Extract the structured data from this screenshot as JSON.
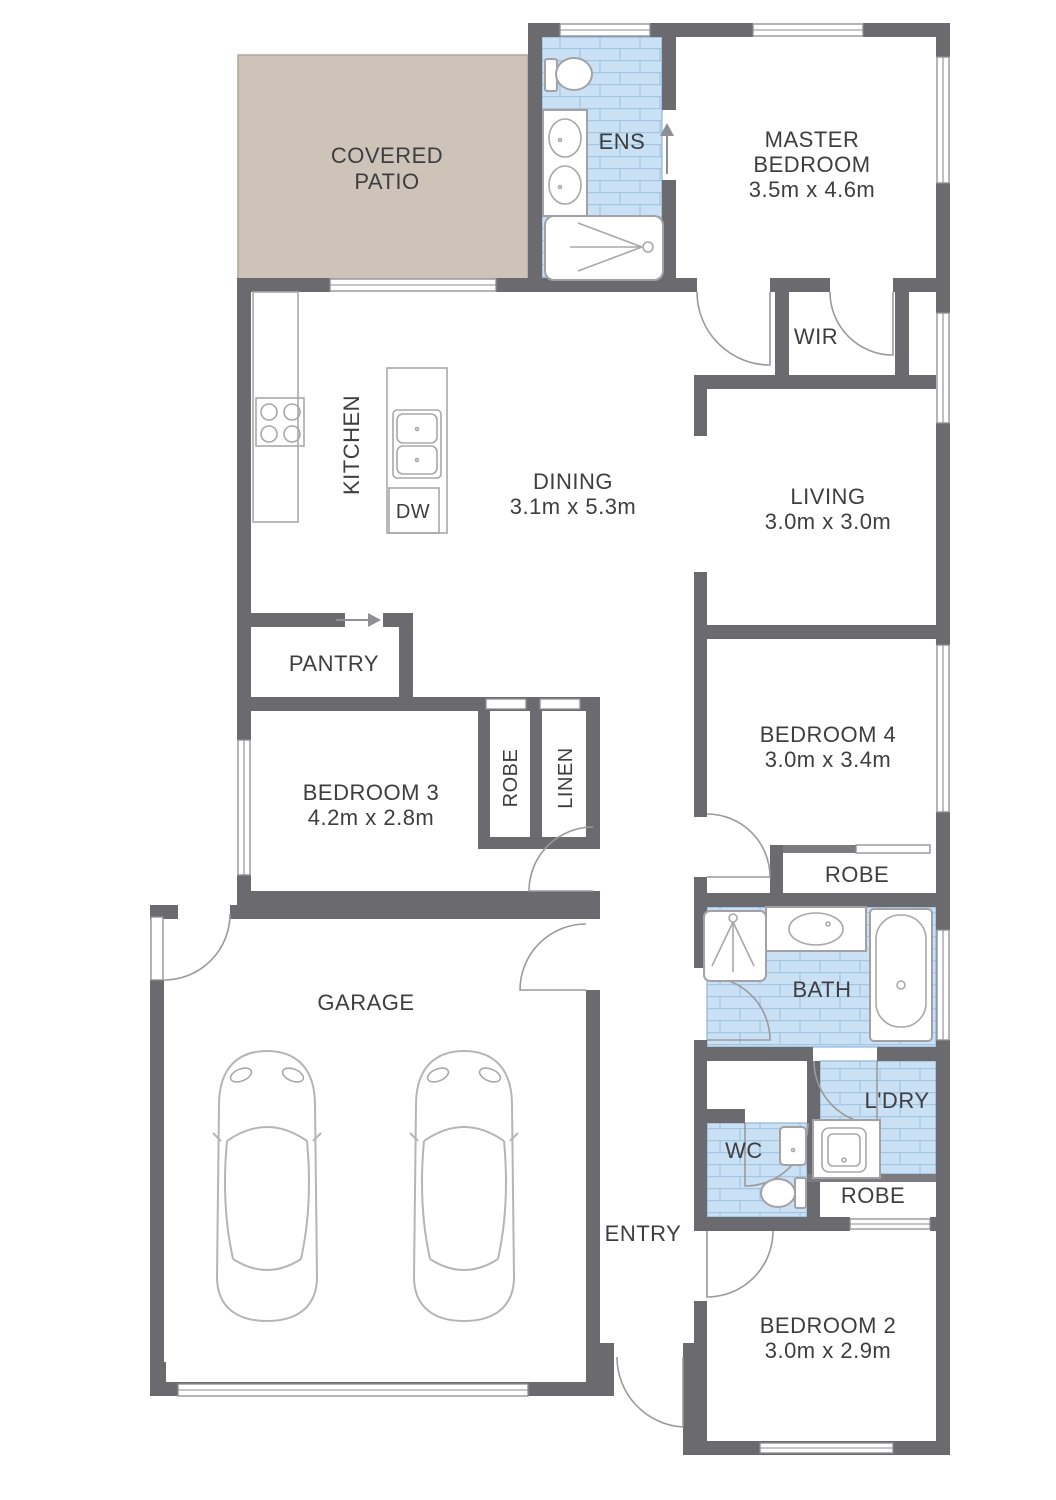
{
  "rooms": {
    "covered_patio": {
      "name_line1": "COVERED",
      "name_line2": "PATIO"
    },
    "ensuite": {
      "name": "ENS"
    },
    "master_bedroom": {
      "name_line1": "MASTER",
      "name_line2": "BEDROOM",
      "dimensions": "3.5m x 4.6m"
    },
    "wir": {
      "name": "WIR"
    },
    "kitchen": {
      "name": "KITCHEN",
      "dishwasher": "DW"
    },
    "dining": {
      "name": "DINING",
      "dimensions": "3.1m x 5.3m"
    },
    "living": {
      "name": "LIVING",
      "dimensions": "3.0m x 3.0m"
    },
    "pantry": {
      "name": "PANTRY"
    },
    "bedroom_3": {
      "name": "BEDROOM 3",
      "dimensions": "4.2m x 2.8m",
      "robe": "ROBE"
    },
    "linen": {
      "name": "LINEN"
    },
    "bedroom_4": {
      "name": "BEDROOM 4",
      "dimensions": "3.0m x 3.4m",
      "robe": "ROBE"
    },
    "bathroom": {
      "name": "BATH"
    },
    "garage": {
      "name": "GARAGE"
    },
    "laundry": {
      "name": "L'DRY"
    },
    "wc": {
      "name": "WC"
    },
    "bedroom_2": {
      "name": "BEDROOM 2",
      "dimensions": "3.0m x 2.9m",
      "robe": "ROBE"
    },
    "entry": {
      "name": "ENTRY"
    }
  },
  "colors": {
    "wall": "#6a6a6f",
    "tile_fill": "#cae0f4",
    "tile_line": "#a3c6e2",
    "patio_fill": "#cdc3b9",
    "text": "#3e3e41",
    "fixture_line": "#a2a2a6"
  }
}
